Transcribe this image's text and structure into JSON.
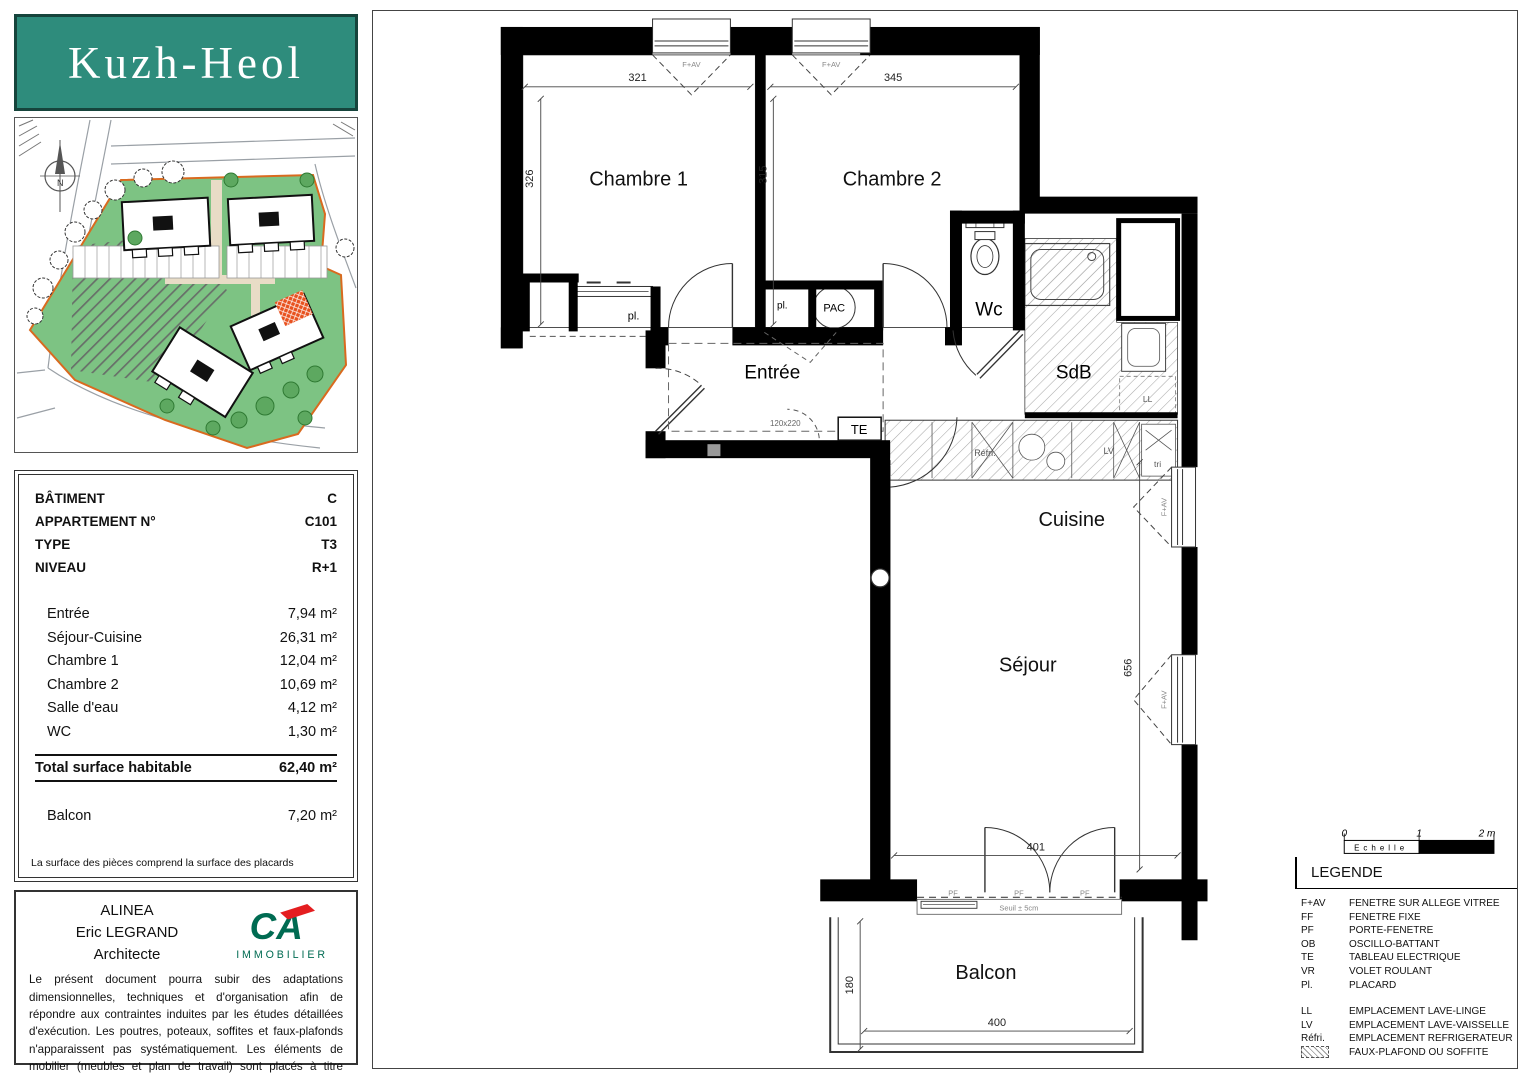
{
  "logo": {
    "title": "Kuzh-Heol"
  },
  "site": {
    "compass": "N"
  },
  "info": {
    "rows": [
      {
        "label": "BÂTIMENT",
        "value": "C"
      },
      {
        "label": "APPARTEMENT N°",
        "value": "C101"
      },
      {
        "label": "TYPE",
        "value": "T3"
      },
      {
        "label": "NIVEAU",
        "value": "R+1"
      }
    ],
    "areas": [
      {
        "label": "Entrée",
        "value": "7,94 m²"
      },
      {
        "label": "Séjour-Cuisine",
        "value": "26,31 m²"
      },
      {
        "label": "Chambre 1",
        "value": "12,04 m²"
      },
      {
        "label": "Chambre 2",
        "value": "10,69 m²"
      },
      {
        "label": "Salle d'eau",
        "value": "4,12 m²"
      },
      {
        "label": "WC",
        "value": "1,30 m²"
      }
    ],
    "total": {
      "label": "Total surface habitable",
      "value": "62,40 m²"
    },
    "balcony": {
      "label": "Balcon",
      "value": "7,20 m²"
    },
    "note": "La surface des pièces comprend la surface des placards"
  },
  "architect": {
    "name": "ALINEA",
    "person": "Eric LEGRAND",
    "role": "Architecte",
    "brand_mark": "CA",
    "brand": "IMMOBILIER",
    "disclaimer": "Le présent document pourra subir des adaptations dimensionnelles, techniques et d'organisation afin de répondre aux contraintes induites par les études détaillées d'exécution. Les poutres, poteaux, soffites et faux-plafonds n'apparaissent pas systématiquement. Les éléments de mobilier (meubles et plan de travail) sont placés à titre indicatif.",
    "date": "Date : 1er Février 2025"
  },
  "plan": {
    "rooms": {
      "chambre1": "Chambre 1",
      "chambre2": "Chambre 2",
      "entree": "Entrée",
      "wc": "Wc",
      "sdb": "SdB",
      "cuisine": "Cuisine",
      "sejour": "Séjour",
      "balcon": "Balcon"
    },
    "labels": {
      "pac": "PAC",
      "te": "TE",
      "pl": "pl.",
      "refri": "Réfri.",
      "lv": "LV",
      "ll": "LL",
      "tri": "tri",
      "fav": "F+AV",
      "pf": "PF",
      "seuil": "Seuil ± 5cm",
      "passage": "120x220"
    },
    "dims": {
      "ch1_w": "321",
      "ch1_h": "326",
      "ch2_w": "345",
      "ch2_h": "315",
      "sejour_h": "656",
      "bay": "401",
      "balcon_w": "400",
      "balcon_d": "180"
    }
  },
  "scale": {
    "n0": "0",
    "n1": "1",
    "n2": "2 m",
    "label": "Echelle"
  },
  "legend": {
    "title": "LEGENDE",
    "items": [
      {
        "abbr": "F+AV",
        "desc": "FENETRE SUR ALLEGE VITREE"
      },
      {
        "abbr": "FF",
        "desc": "FENETRE FIXE"
      },
      {
        "abbr": "PF",
        "desc": "PORTE-FENETRE"
      },
      {
        "abbr": "OB",
        "desc": "OSCILLO-BATTANT"
      },
      {
        "abbr": "TE",
        "desc": "TABLEAU ELECTRIQUE"
      },
      {
        "abbr": "VR",
        "desc": "VOLET ROULANT"
      },
      {
        "abbr": "Pl.",
        "desc": "PLACARD"
      }
    ],
    "items2": [
      {
        "abbr": "LL",
        "desc": "EMPLACEMENT LAVE-LINGE"
      },
      {
        "abbr": "LV",
        "desc": "EMPLACEMENT LAVE-VAISSELLE"
      },
      {
        "abbr": "Réfri.",
        "desc": "EMPLACEMENT REFRIGERATEUR"
      },
      {
        "abbr": "",
        "desc": "FAUX-PLAFOND OU SOFFITE"
      }
    ]
  }
}
